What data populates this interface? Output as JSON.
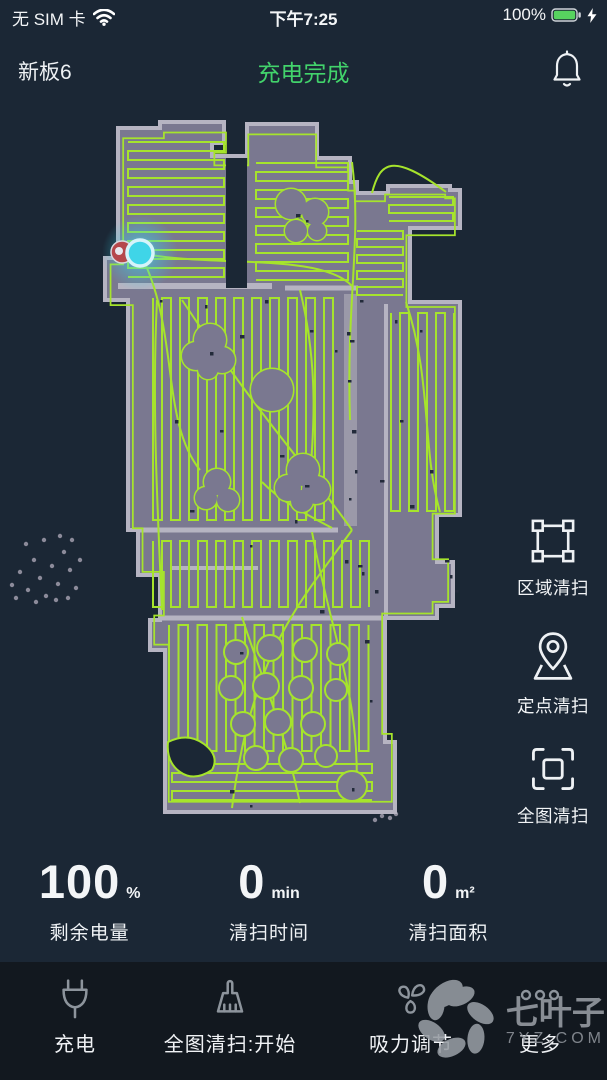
{
  "status_bar": {
    "carrier": "无 SIM 卡",
    "time": "下午7:25",
    "battery_percent": "100%"
  },
  "header": {
    "device_name": "新板6",
    "status_text": "充电完成"
  },
  "side_actions": [
    {
      "icon": "zone-clean-icon",
      "label": "区域清扫"
    },
    {
      "icon": "spot-clean-icon",
      "label": "定点清扫"
    },
    {
      "icon": "full-map-clean-icon",
      "label": "全图清扫"
    }
  ],
  "stats": [
    {
      "value": "100",
      "unit": "%",
      "label": "剩余电量"
    },
    {
      "value": "0",
      "unit": "min",
      "label": "清扫时间"
    },
    {
      "value": "0",
      "unit": "m²",
      "label": "清扫面积"
    }
  ],
  "bottom_nav": [
    {
      "icon": "plug-icon",
      "label": "充电"
    },
    {
      "icon": "broom-icon",
      "label": "全图清扫:开始"
    },
    {
      "icon": "fan-icon",
      "label": "吸力调节"
    },
    {
      "icon": "more-icon",
      "label": "更多"
    }
  ],
  "watermark": {
    "title": "七叶子",
    "domain": "7YZ.COM"
  },
  "colors": {
    "background": "#1b2735",
    "status_green": "#42d36b",
    "battery_green": "#57d35f",
    "path_green": "#a6e42c",
    "floor_gray": "#7a7890",
    "wall_gray": "#b6b4c2",
    "robot_cyan": "#3fd5e8",
    "dock_red": "#b5484b",
    "bottom_bar": "#12181f"
  }
}
